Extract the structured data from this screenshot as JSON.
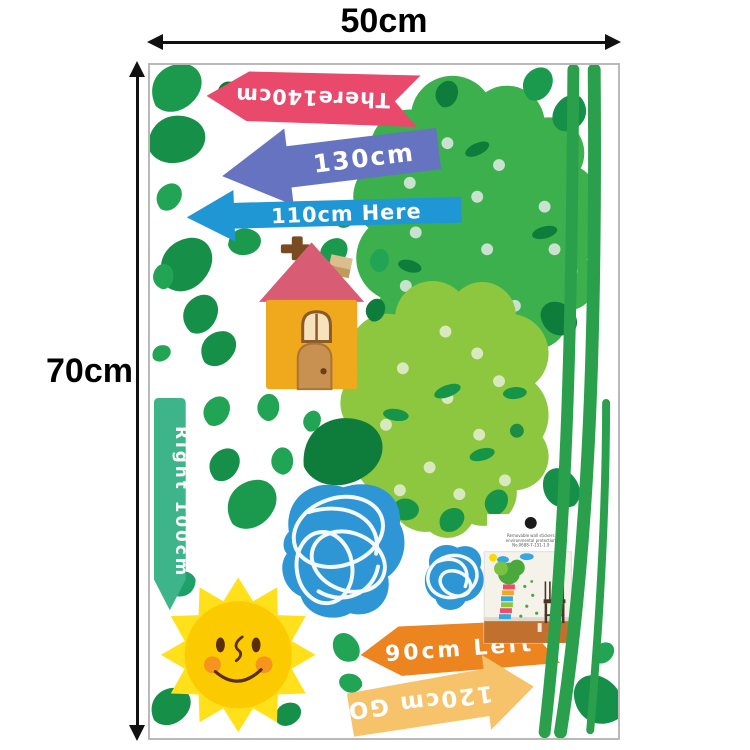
{
  "dims": {
    "width_label": "50cm",
    "height_label": "70cm"
  },
  "stickers": {
    "arrow_140": {
      "label": "There140cm",
      "color": "#e9496b",
      "direction": "left",
      "text_upside_down": true
    },
    "arrow_130": {
      "label": "130cm",
      "color": "#6673c0",
      "direction": "left"
    },
    "arrow_110": {
      "label": "110cm Here",
      "color": "#1f97d4",
      "direction": "left"
    },
    "arrow_100": {
      "label": "Right 100cm",
      "color": "#3db489",
      "direction": "down"
    },
    "arrow_90": {
      "label": "90cm Left",
      "color": "#ec8420",
      "direction": "left"
    },
    "arrow_120": {
      "label": "120cm GO",
      "color": "#f6c36a",
      "direction": "right",
      "text_upside_down": true
    }
  },
  "inset": {
    "lines": [
      "Removable wall stickers",
      "environmental protection",
      "No.0688-7-131-1.9"
    ]
  },
  "palette": {
    "tree_green": "#3cb04c",
    "tree_light_green": "#8dc63f",
    "leaf_dark": "#0e7c3a",
    "leaf_mid": "#169048",
    "leaf_main": "#1b9a4d",
    "leaf_bright": "#22a455",
    "stem_green": "#2aa04d",
    "cloud_blue": "#2f96d5",
    "sun_ray_yellow": "#ffe01a",
    "sun_core_yellow": "#fcca00",
    "house_body": "#f0a81c",
    "house_roof": "#d85c74",
    "dimension_black": "#111111"
  }
}
